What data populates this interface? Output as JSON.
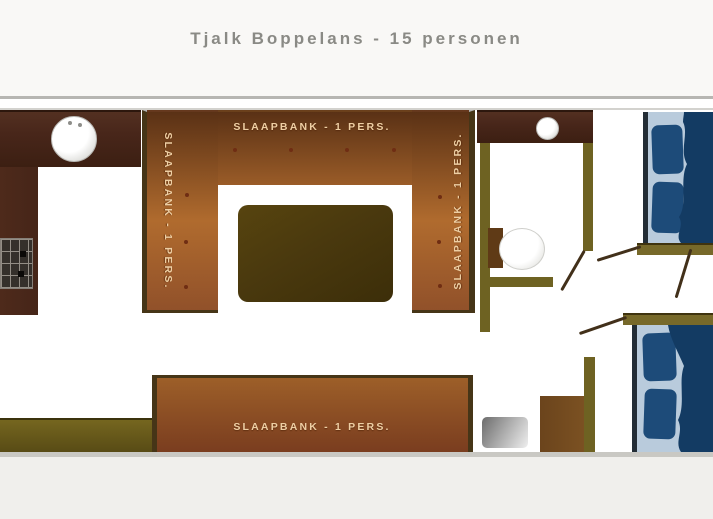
{
  "title": "Tjalk Boppelans - 15 personen",
  "benches": {
    "top": {
      "label": "SLAAPBANK - 1 PERS."
    },
    "left": {
      "label": "SLAAPBANK - 1 PERS."
    },
    "right": {
      "label": "SLAAPBANK - 1 PERS."
    },
    "bottom": {
      "label": "SLAAPBANK - 1 PERS."
    }
  },
  "colors": {
    "title_gray": "#8a8a85",
    "bench_orange": "#b06b2e",
    "bench_shadow": "#5a3115",
    "bench_border": "#463517",
    "bench_text": "#eecfa4",
    "bench_dot": "#6f2d13",
    "wall_olive": "#6e6222",
    "counter_maroon": "#48261a",
    "table_olive": "#4a390e",
    "bed_sheet": "#b9cbdc",
    "bed_pillow": "#1d4b79",
    "bed_duvet": "#133b63",
    "steps_gray": "#9a9a9a",
    "cabinet_brown": "#6b441c"
  }
}
